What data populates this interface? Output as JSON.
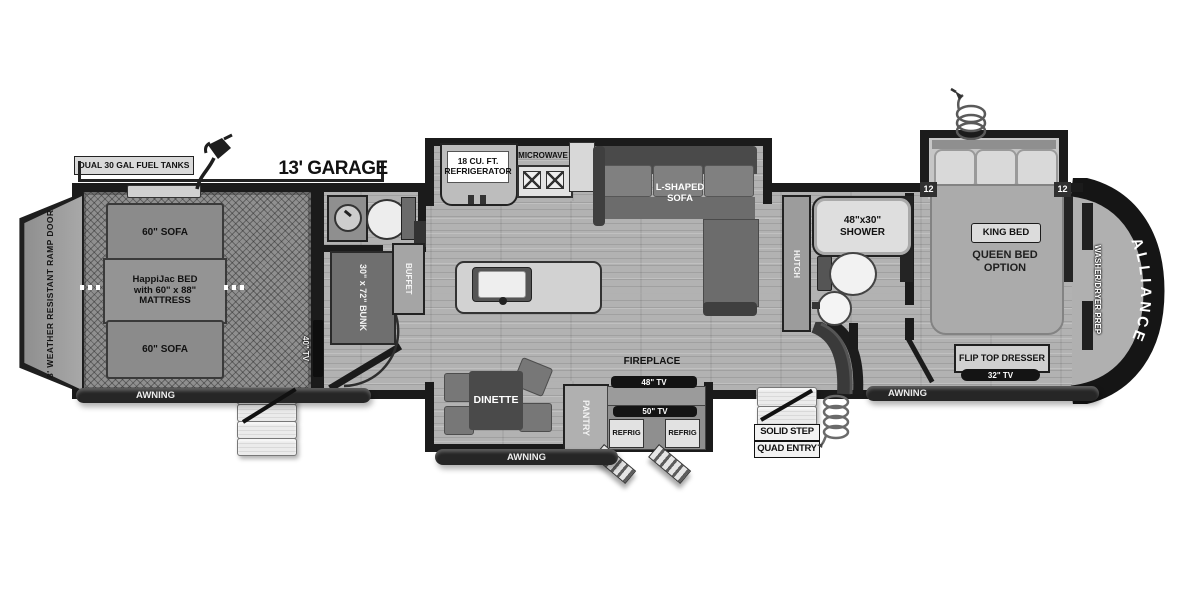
{
  "plan": {
    "header": {
      "fuel_tanks_label": "DUAL 30 GAL FUEL TANKS",
      "garage_length_label": "13' GARAGE"
    },
    "garage": {
      "ramp_door_label": "8' WEATHER RESISTANT RAMP DOOR",
      "sofa_top_label": "60\" SOFA",
      "happijac_line1": "HappiJac BED",
      "happijac_line2": "with 60\" x 88\"",
      "happijac_line3": "MATTRESS",
      "sofa_bottom_label": "60\" SOFA",
      "tv40_label": "40\" TV",
      "bunk_label": "30\" x 72\" BUNK"
    },
    "kitchen": {
      "refrigerator_line1": "18 CU. FT.",
      "refrigerator_line2": "REFRIGERATOR",
      "microwave_label": "MICROWAVE",
      "buffet_label": "BUFFET",
      "pantry_label": "PANTRY"
    },
    "living": {
      "sofa_line1": "L-SHAPED",
      "sofa_line2": "SOFA",
      "fireplace_label": "FIREPLACE",
      "tv48_label": "48\" TV",
      "dinette_label": "DINETTE",
      "hutch_label": "HUTCH"
    },
    "outdoor_kitchen": {
      "tv50_label": "50\" TV",
      "refrig_left_label": "REFRIG",
      "refrig_right_label": "REFRIG"
    },
    "bathroom": {
      "shower_line1": "48\"x30\"",
      "shower_line2": "SHOWER"
    },
    "bedroom": {
      "king_bed_label": "KING BED",
      "queen_line1": "QUEEN BED",
      "queen_line2": "OPTION",
      "slide_left_label": "12",
      "slide_right_label": "12",
      "dresser_label": "FLIP TOP DRESSER",
      "tv32_label": "32\" TV",
      "washer_dryer_label": "WASHER/DRYER PREP"
    },
    "exterior": {
      "awning_left_label": "AWNING",
      "awning_center_label": "AWNING",
      "awning_right_label": "AWNING",
      "entry_line1": "SOLID STEP",
      "entry_line2": "QUAD ENTRY",
      "brand_label": "ALLIANCE"
    }
  }
}
